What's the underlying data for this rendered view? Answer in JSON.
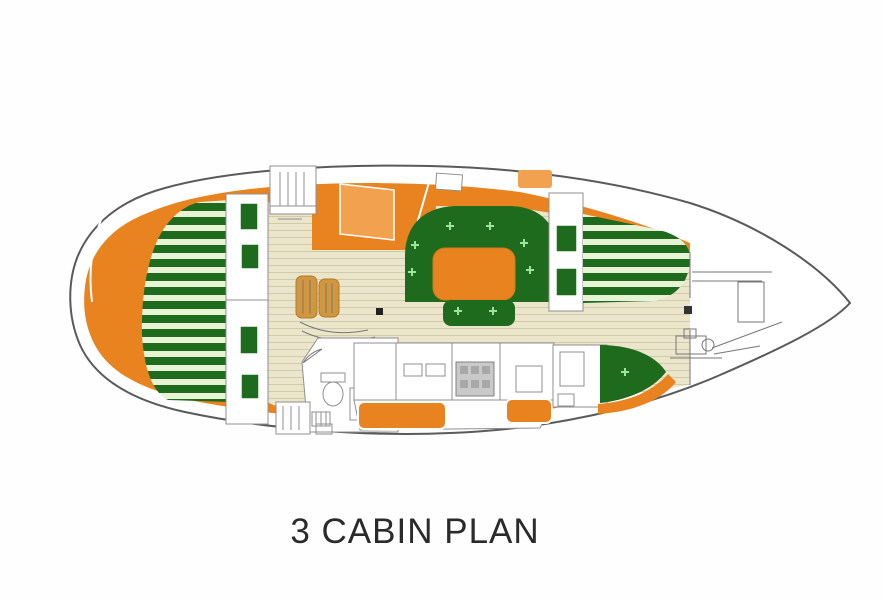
{
  "caption": {
    "text": "3 CABIN PLAN"
  },
  "colors": {
    "page_bg": "#fefefe",
    "hull_line": "#5a5a5c",
    "deck_orange": "#e8831f",
    "accent_orange_light": "#f2a14f",
    "cushion_green": "#1e6b1e",
    "stripe_pale_green": "#e6f3d4",
    "tuft_green": "#9ce39c",
    "floor_beige": "#ebe6cb",
    "floor_line": "#d2cba8",
    "wood_steps": "#d0973f",
    "outline_gray": "#8f8f8f",
    "detail_gray": "#777777",
    "caption_color": "#2b2b2b"
  }
}
